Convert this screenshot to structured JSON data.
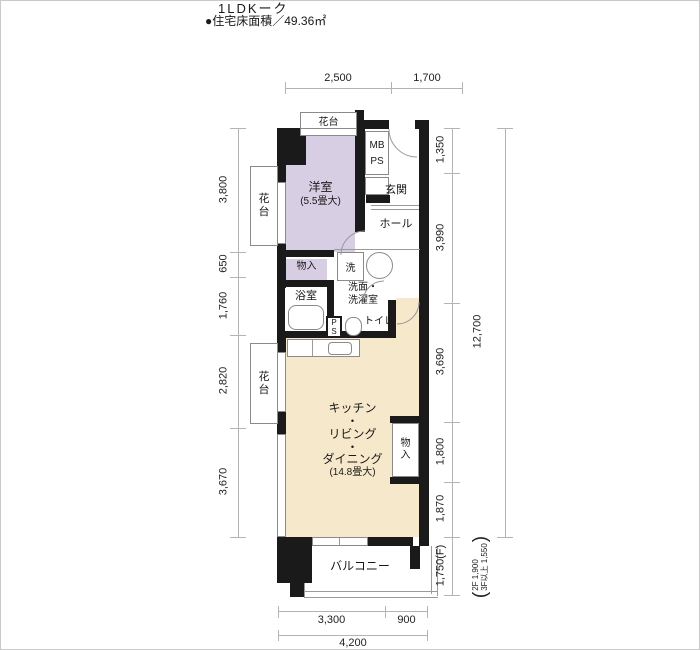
{
  "title": "1LDKーク",
  "floor_area": "●住宅床面積／49.36㎡",
  "rooms": {
    "yoshitsu_name": "洋室",
    "yoshitsu_size": "(5.5畳大)",
    "genkan": "玄関",
    "hall": "ホール",
    "mb": "MB",
    "ps": "PS",
    "p": "P",
    "s": "S",
    "monoire": "物入",
    "mono": "物",
    "ire": "入",
    "sen": "洗",
    "senmen_line1": "洗面・",
    "senmen_line2": "洗濯室",
    "yokushitsu": "浴室",
    "toilet": "トイレ",
    "balcony": "バルコニー",
    "kadai": "花台",
    "ldk_lines": [
      "キッチン",
      "・",
      "リビング",
      "・",
      "ダイニング",
      "(14.8畳大)"
    ]
  },
  "dims": {
    "top": [
      "2,500",
      "1,700"
    ],
    "left": [
      "3,800",
      "650",
      "1,760",
      "2,820",
      "3,670"
    ],
    "right": [
      "1,350",
      "3,990",
      "3,690",
      "1,800",
      "1,870",
      "1,750(F)"
    ],
    "right_total": "12,700",
    "note_open": "(",
    "note_line1": "2F 1,900",
    "note_line2": "3F以上 1,550",
    "note_close": ")",
    "bottom": [
      "3,300",
      "900"
    ],
    "bottom_total": "4,200"
  },
  "colors": {
    "bedroom_fill": "#d7cee3",
    "ldk_fill": "#f6e8ca",
    "wall": "#1a1a1a"
  }
}
